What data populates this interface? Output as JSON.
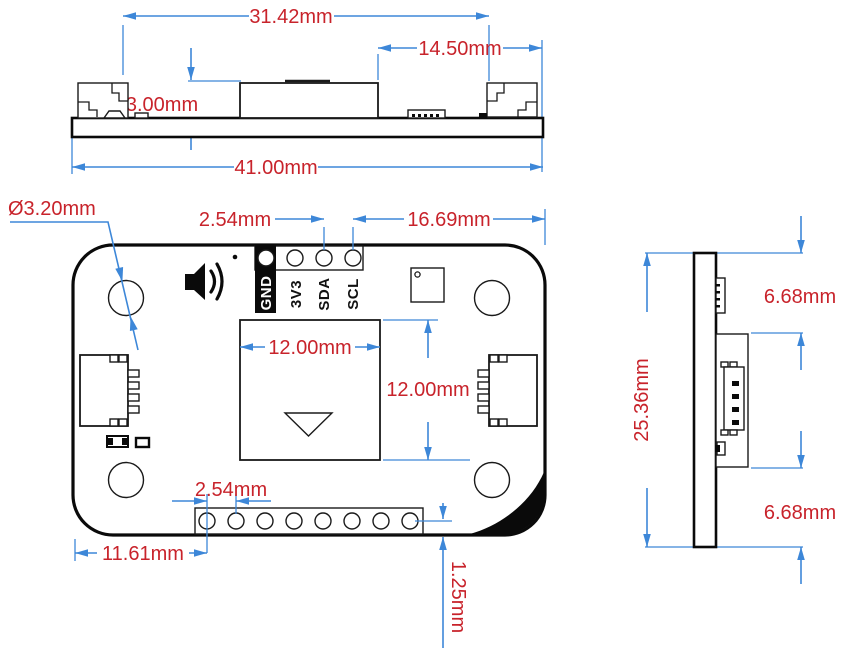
{
  "drawing_title": "PCB module dimension drawing, three orthographic views",
  "colors": {
    "dimension_line": "#3d87d8",
    "dimension_text": "#c8232b",
    "outline": "#111111",
    "label_tab_background": "#0a0a0a"
  },
  "top_view": {
    "dims": {
      "span_inner": "31.42mm",
      "span_right": "14.50mm",
      "component_height": "3.00mm",
      "overall_width": "41.00mm"
    }
  },
  "front_view": {
    "dims": {
      "hole_diameter": "Ø3.20mm",
      "pin_pitch_top": "2.54mm",
      "span_top_right": "16.69mm",
      "sensor_width": "12.00mm",
      "sensor_height": "12.00mm",
      "pin_pitch_bottom": "2.54mm",
      "offset_bottom_left": "11.61mm",
      "offset_bottom_edge": "1.25mm"
    },
    "pin_labels": [
      "GND",
      "3V3",
      "SDA",
      "SCL"
    ]
  },
  "side_view": {
    "dims": {
      "board_height": "25.36mm",
      "offset_top": "6.68mm",
      "offset_bottom": "6.68mm"
    }
  }
}
